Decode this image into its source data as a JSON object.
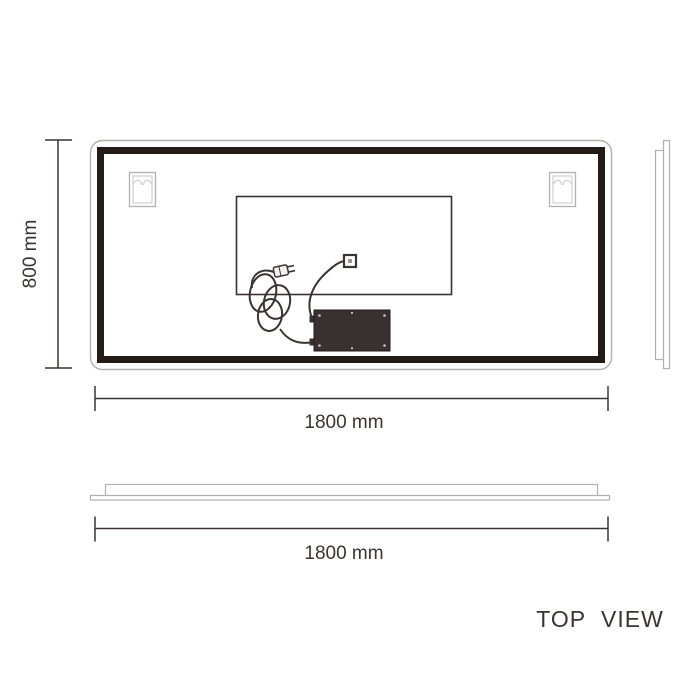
{
  "labels": {
    "back_height": "800 mm",
    "back_width": "1800 mm",
    "top_width": "1800 mm",
    "view_caption": "TOP VIEW"
  },
  "colors": {
    "line": "#3b3331",
    "frame": "#241a16",
    "light_outline": "#b3b0ae",
    "driver_box": "#393031",
    "background": "#ffffff"
  }
}
